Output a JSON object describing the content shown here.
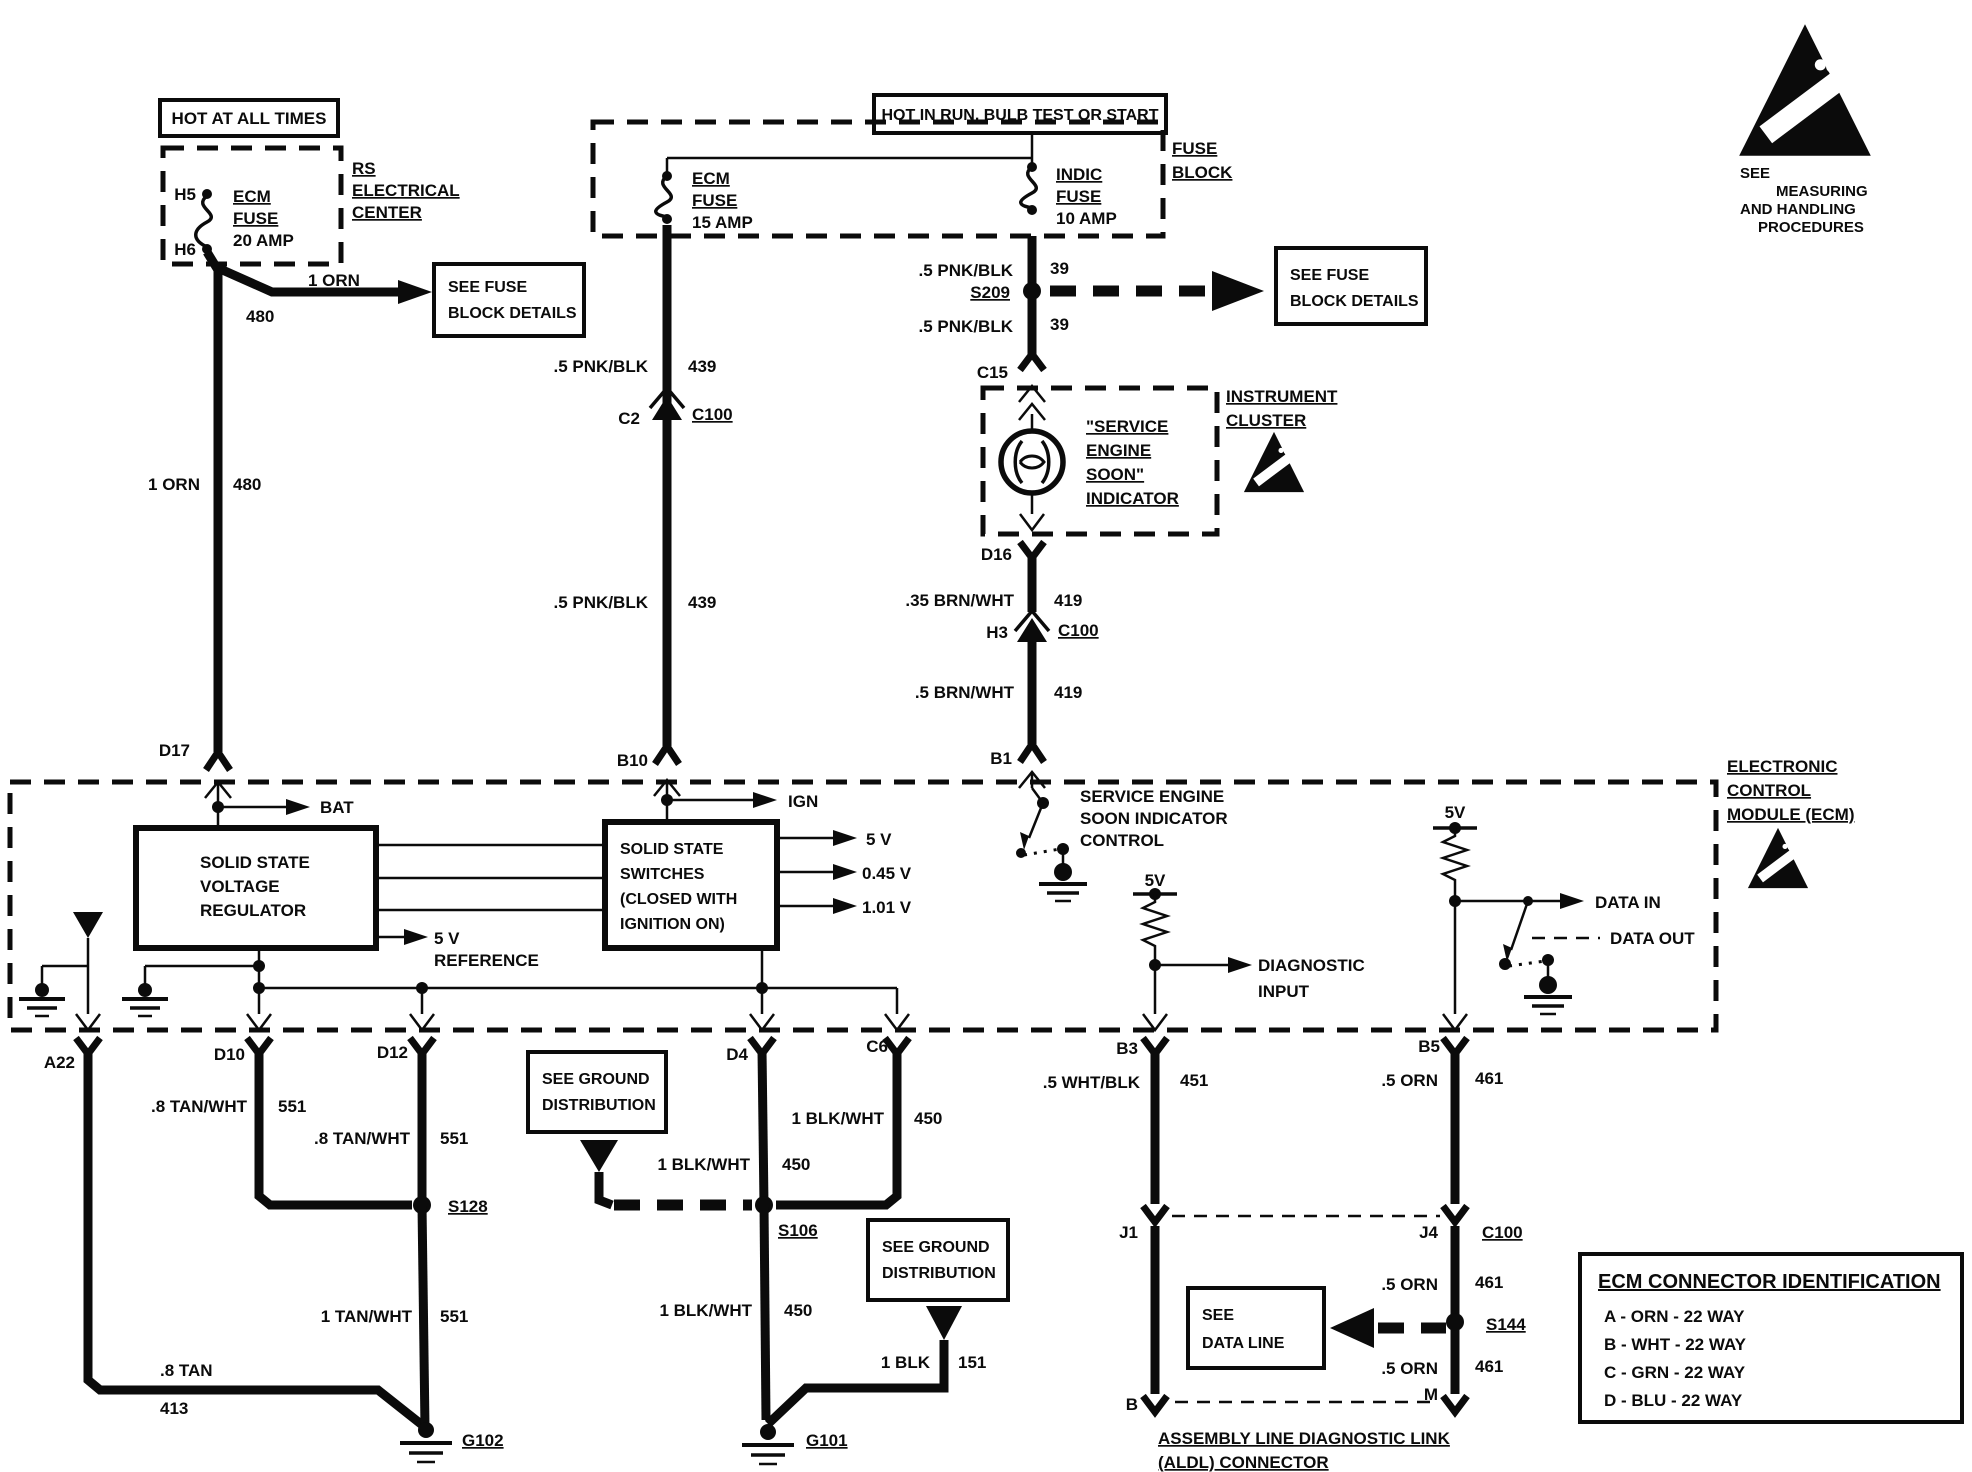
{
  "banners": {
    "hot_at_all_times": "HOT AT ALL TIMES",
    "hot_in_run": "HOT IN RUN, BULB TEST OR START"
  },
  "esd_note": {
    "l1": "SEE",
    "l2": "MEASURING",
    "l3": "AND HANDLING",
    "l4": "PROCEDURES"
  },
  "rs_center": {
    "pin_top": "H5",
    "pin_bottom": "H6",
    "fuse": {
      "l1": "ECM",
      "l2": "FUSE",
      "l3": "20 AMP"
    },
    "label": {
      "l1": "RS",
      "l2": "ELECTRICAL",
      "l3": "CENTER"
    }
  },
  "fuse_block": {
    "ecm_fuse": {
      "l1": "ECM",
      "l2": "FUSE",
      "l3": "15 AMP"
    },
    "indic_fuse": {
      "l1": "INDIC",
      "l2": "FUSE",
      "l3": "10 AMP"
    },
    "label": {
      "l1": "FUSE",
      "l2": "BLOCK"
    }
  },
  "ref_boxes": {
    "see_fuse_left": {
      "l1": "SEE FUSE",
      "l2": "BLOCK DETAILS"
    },
    "see_fuse_right": {
      "l1": "SEE FUSE",
      "l2": "BLOCK DETAILS"
    },
    "see_ground_a": {
      "l1": "SEE GROUND",
      "l2": "DISTRIBUTION"
    },
    "see_ground_b": {
      "l1": "SEE GROUND",
      "l2": "DISTRIBUTION"
    },
    "see_data": {
      "l1": "SEE",
      "l2": "DATA LINE"
    }
  },
  "cluster": {
    "label": {
      "l1": "INSTRUMENT",
      "l2": "CLUSTER"
    },
    "indicator": {
      "l1": "\"SERVICE",
      "l2": "ENGINE",
      "l3": "SOON\"",
      "l4": "INDICATOR"
    },
    "pin_in": "C15",
    "pin_out": "D16"
  },
  "ecm": {
    "label": {
      "l1": "ELECTRONIC",
      "l2": "CONTROL",
      "l3": "MODULE (ECM)"
    },
    "regulator": {
      "l1": "SOLID STATE",
      "l2": "VOLTAGE",
      "l3": "REGULATOR"
    },
    "switches": {
      "l1": "SOLID STATE",
      "l2": "SWITCHES",
      "l3": "(CLOSED WITH",
      "l4": "IGNITION ON)"
    },
    "bat": "BAT",
    "ign": "IGN",
    "out_5v": "5 V",
    "out_045v": "0.45 V",
    "out_101v": "1.01 V",
    "ref": {
      "l1": "5 V",
      "l2": "REFERENCE"
    },
    "ses_control": {
      "l1": "SERVICE ENGINE",
      "l2": "SOON INDICATOR",
      "l3": "CONTROL"
    },
    "pullup_diag_5v": "5V",
    "pullup_data_5v": "5V",
    "diag": {
      "l1": "DIAGNOSTIC",
      "l2": "INPUT"
    },
    "data_in": "DATA IN",
    "data_out": "DATA OUT"
  },
  "pins": {
    "d17": "D17",
    "b10": "B10",
    "b1": "B1",
    "c2": "C2",
    "c2_c100": "C100",
    "h3": "H3",
    "h3_c100": "C100",
    "a22": "A22",
    "d10": "D10",
    "d12": "D12",
    "d4": "D4",
    "c6": "C6",
    "b3": "B3",
    "b5": "B5",
    "j1": "J1",
    "j4": "J4",
    "j4_c100": "C100",
    "b": "B",
    "m": "M"
  },
  "wires": {
    "orn_branch": {
      "color": "1 ORN",
      "circuit": "480"
    },
    "orn_main": {
      "color": "1 ORN",
      "circuit": "480"
    },
    "pnk_439_up": {
      "color": ".5 PNK/BLK",
      "circuit": "439"
    },
    "pnk_439_dn": {
      "color": ".5 PNK/BLK",
      "circuit": "439"
    },
    "pnk_39_up": {
      "color": ".5 PNK/BLK",
      "circuit": "39"
    },
    "pnk_39_dn": {
      "color": ".5 PNK/BLK",
      "circuit": "39"
    },
    "brn_419_up": {
      "color": ".35 BRN/WHT",
      "circuit": "419"
    },
    "brn_419_dn": {
      "color": ".5 BRN/WHT",
      "circuit": "419"
    },
    "tan_d10": {
      "color": ".8 TAN/WHT",
      "circuit": "551"
    },
    "tan_d12": {
      "color": ".8 TAN/WHT",
      "circuit": "551"
    },
    "tan_s128": {
      "color": "1 TAN/WHT",
      "circuit": "551"
    },
    "tan_a22": {
      "color": ".8 TAN",
      "circuit": "413"
    },
    "blk_d4": {
      "color": "1 BLK/WHT",
      "circuit": "450"
    },
    "blk_c6": {
      "color": "1 BLK/WHT",
      "circuit": "450"
    },
    "blk_s106": {
      "color": "1 BLK/WHT",
      "circuit": "450"
    },
    "blk_151": {
      "color": "1 BLK",
      "circuit": "151"
    },
    "wht_451": {
      "color": ".5 WHT/BLK",
      "circuit": "451"
    },
    "orn_461_up": {
      "color": ".5 ORN",
      "circuit": "461"
    },
    "orn_461_mid": {
      "color": ".5 ORN",
      "circuit": "461"
    },
    "orn_461_dn": {
      "color": ".5 ORN",
      "circuit": "461"
    }
  },
  "splices": {
    "s209": "S209",
    "s128": "S128",
    "s106": "S106",
    "s144": "S144"
  },
  "grounds": {
    "g101": "G101",
    "g102": "G102"
  },
  "aldl": {
    "l1": "ASSEMBLY LINE DIAGNOSTIC LINK",
    "l2": "(ALDL) CONNECTOR"
  },
  "connector_table": {
    "title": "ECM CONNECTOR IDENTIFICATION",
    "rows": [
      "A - ORN - 22 WAY",
      "B - WHT - 22 WAY",
      "C - GRN - 22 WAY",
      "D - BLU - 22 WAY"
    ]
  }
}
